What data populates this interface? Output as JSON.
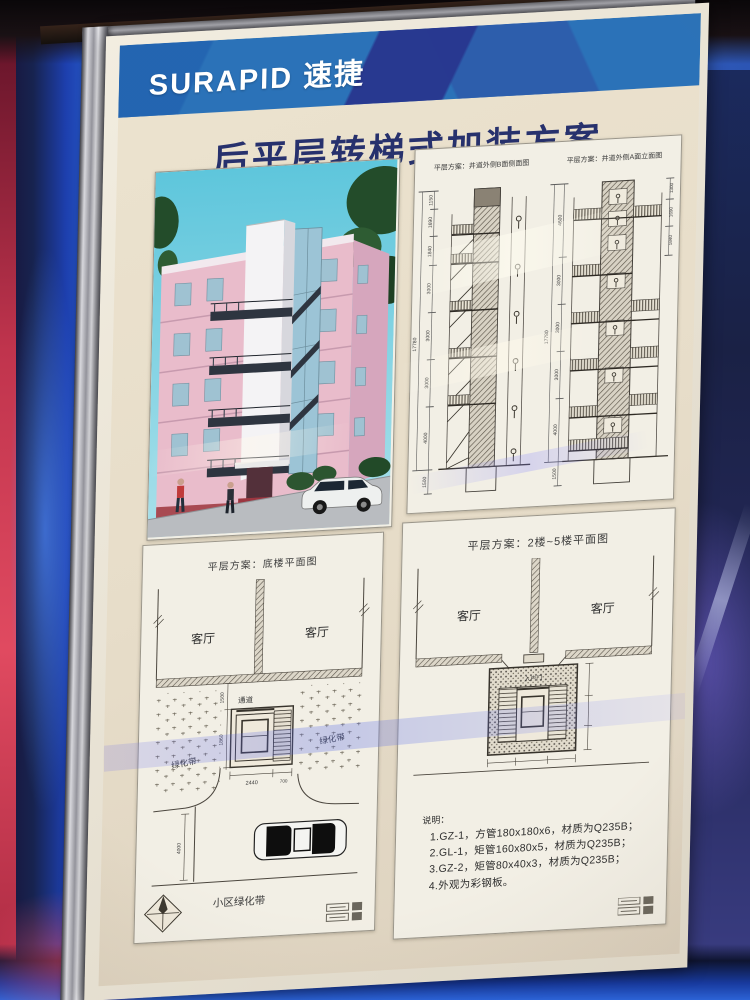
{
  "colors": {
    "header_blue": "#2b72b8",
    "header_navy": "#28368e",
    "title_navy": "#27316d",
    "poster_cream": "#e9e0cc",
    "accent_red": "#c0344d"
  },
  "poster": {
    "brand": "SURAPID 速捷",
    "title": "后平层转梯式加装方案"
  },
  "elevation_panel": {
    "label_b": "平层方案：井道外侧B面侧面图",
    "label_a": "平层方案：井道外侧A面立面图",
    "b": {
      "total": "17780",
      "base": "1500",
      "segments": [
        "1150",
        "1690",
        "1840",
        "3000",
        "3000",
        "3000",
        "4000"
      ]
    },
    "a": {
      "total": "17780",
      "base": "1500",
      "segments": [
        "4600",
        "3000",
        "3000",
        "3000",
        "4000"
      ],
      "right_segments": [
        "1300",
        "1690",
        "1840"
      ]
    }
  },
  "ground_plan_panel": {
    "label": "平层方案：底楼平面图",
    "living_left": "客厅",
    "living_right": "客厅",
    "passage": "通道",
    "green_left": "绿化带",
    "green_right": "绿化带",
    "community_green": "小区绿化带",
    "dims": {
      "top": "1500",
      "depth": "1860",
      "width": "2440",
      "offset": "700",
      "road": "4000"
    }
  },
  "upper_plan_panel": {
    "label": "平层方案：2楼~5楼平面图",
    "living_left": "客厅",
    "living_right": "客厅",
    "entry": "入户门",
    "notes_title": "说明：",
    "notes": [
      "1.GZ-1，方管180x180x6，材质为Q235B；",
      "2.GL-1，矩管160x80x5，材质为Q235B；",
      "3.GZ-2，矩管80x40x3，材质为Q235B；",
      "4.外观为彩钢板。"
    ]
  }
}
